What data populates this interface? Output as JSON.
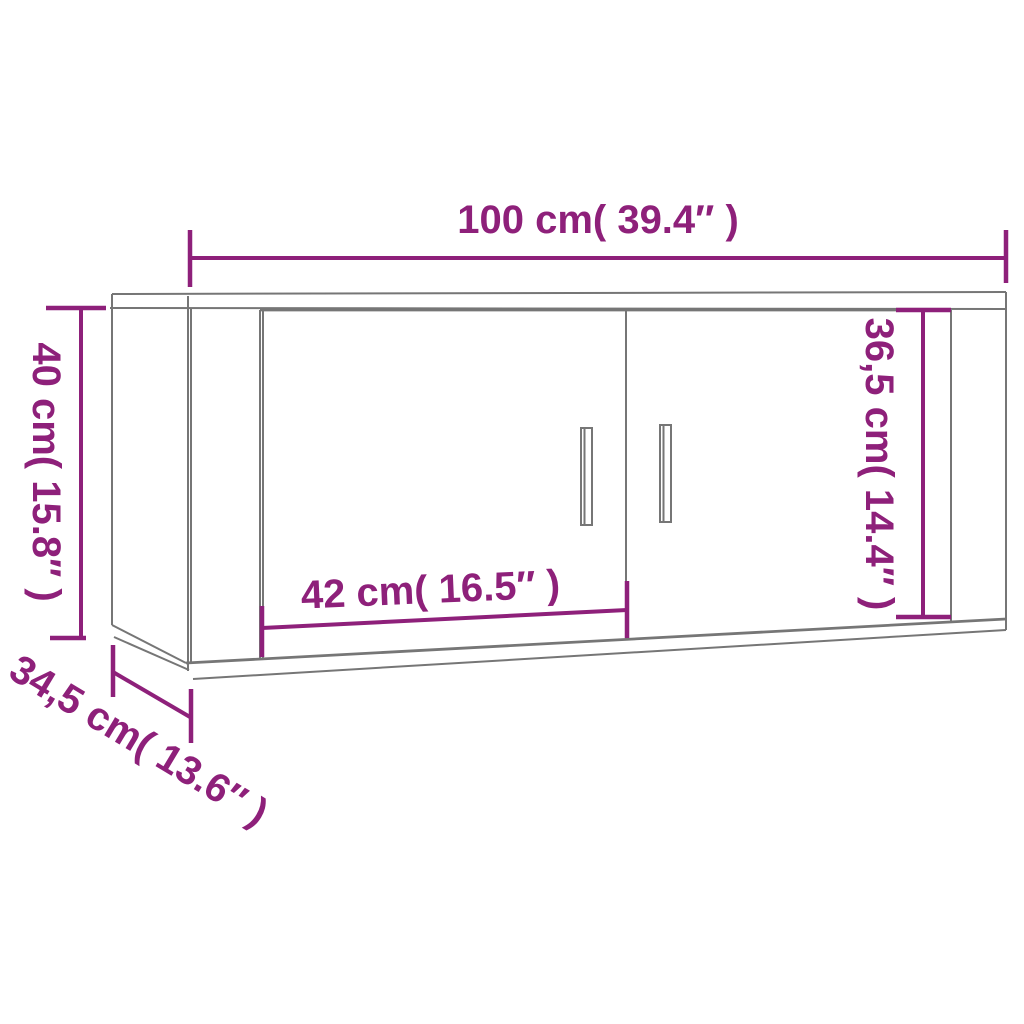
{
  "diagram": {
    "colors": {
      "dimension": "#8e207a",
      "outline": "#767676",
      "background": "#ffffff"
    },
    "dimensions": {
      "overall_width": {
        "label": "100 cm( 39.4″ )",
        "cm": "100",
        "inches": "39.4"
      },
      "overall_height": {
        "label": "40 cm( 15.8″ )",
        "cm": "40",
        "inches": "15.8"
      },
      "depth": {
        "label": "34,5 cm( 13.6″ )",
        "cm": "34,5",
        "inches": "13.6"
      },
      "door_width": {
        "label": "42 cm( 16.5″ )",
        "cm": "42",
        "inches": "16.5"
      },
      "door_height": {
        "label": "36,5 cm( 14.4″ )",
        "cm": "36,5",
        "inches": "14.4"
      }
    }
  }
}
